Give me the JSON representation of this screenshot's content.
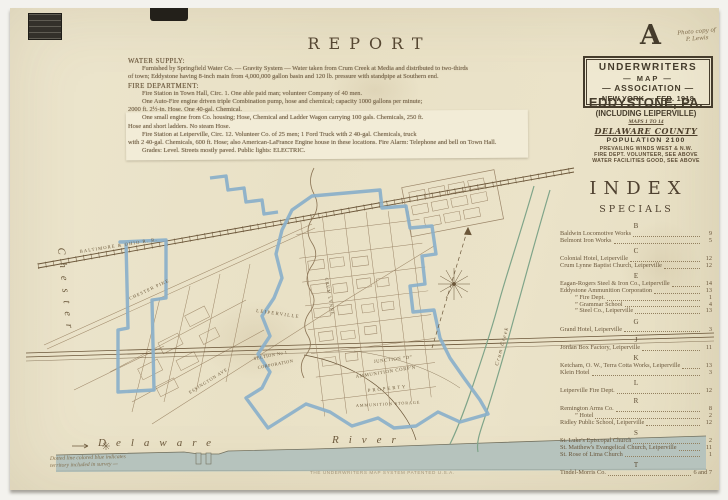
{
  "colors": {
    "paper": "#e9e1c6",
    "ink": "#453c2c",
    "survey_blue": "#8ab0ca",
    "creek_green": "#7fa489",
    "river": "#b6c3bd"
  },
  "page": {
    "title_letter": "A",
    "handwritten_note": [
      "Photo copy of",
      "P. Lewis"
    ]
  },
  "report": {
    "title": "REPORT",
    "lines": [
      {
        "style": "head",
        "text": "WATER SUPPLY:"
      },
      {
        "style": "body",
        "text": "Furnished by Springfield Water Co. — Gravity System — Water taken from Crum Creek at Media and distributed to two-thirds"
      },
      {
        "style": "body2",
        "text": "of town; Eddystone having 8-inch main from 4,000,000 gallon basin and 120 lb. pressure with standpipe at Southern end."
      },
      {
        "style": "head",
        "text": "FIRE DEPARTMENT:"
      },
      {
        "style": "body",
        "text": "Fire Station in Town Hall, Circ. 1.  One able paid man; volunteer Company of 40 men."
      },
      {
        "style": "body",
        "text": "One Auto-Fire engine driven triple Combination pump, hose and chemical; capacity 1000 gallons per minute;"
      },
      {
        "style": "body2",
        "text": "2000 ft. 2½-in. Hose.  One 40-gal. Chemical."
      },
      {
        "style": "body",
        "text": "One small engine from Co. housing; Hose, Chemical and Ladder Wagon carrying 100 gals. Chemicals, 250 ft."
      },
      {
        "style": "body2",
        "text": "Hose and short ladders.  No steam Hose."
      },
      {
        "style": "body",
        "text": "Fire Station at Leiperville, Circ. 12.  Volunteer Co. of 25 men; 1 Ford Truck with 2 40-gal. Chemicals, truck"
      },
      {
        "style": "body2",
        "text": "with 2 40-gal. Chemicals, 600 ft. Hose; also American-LaFrance Engine house in these locations.  Fire Alarm: Telephone and bell on Town Hall."
      },
      {
        "style": "body",
        "text": "Grades: Level.  Streets mostly paved.  Public lights: ELECTRIC."
      }
    ]
  },
  "publisher_box": {
    "l1": "UNDERWRITERS",
    "l2": "— MAP —",
    "l3": "— ASSOCIATION —",
    "l4": "NEW YORK — FEB. 1918"
  },
  "title_block": {
    "city": "EDDYSTONE, PA.",
    "subtitle": "(INCLUDING LEIPERVILLE)",
    "maps_note": "MAPS 1 TO 14",
    "county": "DELAWARE COUNTY",
    "population": "POPULATION  2100",
    "details": [
      "PREVAILING WINDS WEST & N.W.",
      "FIRE DEPT. VOLUNTEER, SEE ABOVE",
      "WATER FACILITIES GOOD, SEE ABOVE"
    ]
  },
  "index": {
    "title": "INDEX",
    "subtitle": "SPECIALS",
    "sections": [
      {
        "letter": "B",
        "entries": [
          {
            "name": "Baldwin Locomotive Works",
            "page": "9"
          },
          {
            "name": "Belmont Iron Works",
            "page": "5"
          }
        ]
      },
      {
        "letter": "C",
        "entries": [
          {
            "name": "Colonial Hotel, Leiperville",
            "page": "12"
          },
          {
            "name": "Crum Lynne Baptist Church, Leiperville",
            "page": "12"
          }
        ]
      },
      {
        "letter": "E",
        "entries": [
          {
            "name": "Eagan-Rogers Steel & Iron Co., Leiperville",
            "page": "14"
          },
          {
            "name": "Eddystone Ammunition Corporation",
            "page": "13"
          },
          {
            "name": "”  Fire Dept.",
            "page": "1",
            "indent": true
          },
          {
            "name": "”  Grammar School",
            "page": "4",
            "indent": true
          },
          {
            "name": "”  Steel Co., Leiperville",
            "page": "13",
            "indent": true
          }
        ]
      },
      {
        "letter": "G",
        "entries": [
          {
            "name": "Grand Hotel, Leiperville",
            "page": "3"
          }
        ]
      },
      {
        "letter": "J",
        "entries": [
          {
            "name": "Jordan Box Factory, Leiperville",
            "page": "11"
          }
        ]
      },
      {
        "letter": "K",
        "entries": [
          {
            "name": "Ketcham, O. W., Terra Cotta Works, Leiperville",
            "page": "13"
          },
          {
            "name": "Klein Hotel",
            "page": "3"
          }
        ]
      },
      {
        "letter": "L",
        "entries": [
          {
            "name": "Leiperville Fire Dept.",
            "page": "12"
          }
        ]
      },
      {
        "letter": "R",
        "entries": [
          {
            "name": "Remington Arms Co.",
            "page": "8"
          },
          {
            "name": "”  Hotel",
            "page": "2",
            "indent": true
          },
          {
            "name": "Ridley Public School, Leiperville",
            "page": "12"
          }
        ]
      },
      {
        "letter": "S",
        "entries": [
          {
            "name": "St. Luke's Episcopal Church",
            "page": "2"
          },
          {
            "name": "St. Matthew's Evangelical Church, Leiperville",
            "page": "11"
          },
          {
            "name": "St. Rose of Lima Church",
            "page": "1"
          }
        ]
      },
      {
        "letter": "T",
        "entries": [
          {
            "name": "Tindel-Morris Co.",
            "page": "6 and 7"
          }
        ]
      }
    ]
  },
  "map": {
    "labels": [
      {
        "t": "Chester",
        "x": 44,
        "y": 98,
        "r": 84,
        "s": 10.5,
        "sp": 8,
        "i": 1
      },
      {
        "t": "BALTIMORE & OHIO R. R.",
        "x": 66,
        "y": 103,
        "r": -9,
        "s": 4.6,
        "sp": 1.1
      },
      {
        "t": "CHESTER PIKE",
        "x": 116,
        "y": 150,
        "r": -25,
        "s": 4.6,
        "sp": 1
      },
      {
        "t": "ESSINGTON AVE.",
        "x": 176,
        "y": 244,
        "r": -32,
        "s": 4.5,
        "sp": 0.8
      },
      {
        "t": "LEIPERVILLE",
        "x": 242,
        "y": 162,
        "r": 8,
        "s": 4.8,
        "sp": 1.3
      },
      {
        "t": "CRUM LYNNE",
        "x": 311,
        "y": 128,
        "r": 80,
        "s": 4.5,
        "sp": 0.9
      },
      {
        "t": "SECTION No 1",
        "x": 240,
        "y": 210,
        "r": -11,
        "s": 4.4,
        "sp": 0.5
      },
      {
        "t": "CORPORATION",
        "x": 244,
        "y": 219,
        "r": -11,
        "s": 4.4,
        "sp": 0.5
      },
      {
        "t": "JUNCTION “D”",
        "x": 360,
        "y": 213,
        "r": -7,
        "s": 4.7,
        "sp": 0.6
      },
      {
        "t": "AMMUNITION CORP'N",
        "x": 342,
        "y": 228,
        "r": -9,
        "s": 4.7,
        "sp": 0.7
      },
      {
        "t": "PROPERTY",
        "x": 354,
        "y": 242,
        "r": -6,
        "s": 4.7,
        "sp": 2
      },
      {
        "t": "AMMUNITION STORAGE",
        "x": 342,
        "y": 257,
        "r": -3,
        "s": 4.2,
        "sp": 0.9
      },
      {
        "t": "Crum Creek",
        "x": 484,
        "y": 216,
        "r": -75,
        "s": 5.4,
        "sp": 1.4,
        "i": 1
      },
      {
        "t": "Delaware",
        "x": 84,
        "y": 296,
        "r": 0,
        "s": 11,
        "sp": 10,
        "i": 1
      },
      {
        "t": "River",
        "x": 318,
        "y": 293,
        "r": 0,
        "s": 11,
        "sp": 10,
        "i": 1
      }
    ]
  },
  "footnotes": {
    "survey_note": [
      "Dotted line colored blue indicates",
      "territory included in survey —"
    ],
    "imprint": "THE UNDERWRITERS MAP SYSTEM PATENTED U.S.A."
  }
}
